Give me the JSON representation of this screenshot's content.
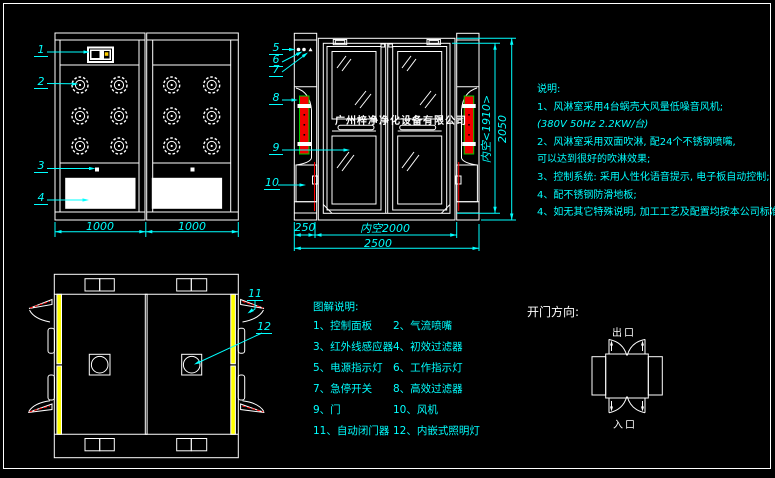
{
  "watermark": "广州梓净净化设备有限公司",
  "callouts": {
    "c1": "1",
    "c2": "2",
    "c3": "3",
    "c4": "4",
    "c5": "5",
    "c6": "6",
    "c7": "7",
    "c8": "8",
    "c9": "9",
    "c10": "10",
    "c11": "11",
    "c12": "12"
  },
  "dimensions": {
    "side_bay_left": "1000",
    "side_bay_right": "1000",
    "front_side_box": "250",
    "front_inner_width": "内空2000",
    "front_total_width": "2500",
    "front_inner_height": "内空<1910>",
    "front_total_height": "2050"
  },
  "legend": {
    "title": "图解说明:",
    "rows": [
      {
        "left": "1、控制面板",
        "right": "2、气流喷嘴"
      },
      {
        "left": "3、红外线感应器",
        "right": "4、初效过滤器"
      },
      {
        "left": "5、电源指示灯",
        "right": "6、工作指示灯"
      },
      {
        "left": "7、急停开关",
        "right": "8、高效过滤器"
      },
      {
        "left": "9、门",
        "right": "10、风机"
      },
      {
        "left": "11、自动闭门器",
        "right": "12、内嵌式照明灯"
      }
    ]
  },
  "notes": {
    "title": "说明:",
    "lines": [
      "1、风淋室采用4台蜗壳大风量低噪音风机;",
      "(380V  50Hz  2.2KW/台)",
      "2、风淋室采用双面吹淋, 配24个不锈钢喷嘴,",
      "可以达到很好的吹淋效果;",
      "3、控制系统: 采用人性化语音提示, 电子板自动控制;",
      "4、配不锈钢防滑地板;",
      "4、如无其它特殊说明, 加工工艺及配置均按本公司标准制作."
    ]
  },
  "door_direction": {
    "title": "开门方向:",
    "exit": "出口",
    "entrance": "入口"
  },
  "colors": {
    "annotation": "#00ffff",
    "linework": "#ffffff",
    "hepa_strip_fill": "#f20000",
    "hepa_strip_outline": "#00cc00",
    "lamp_strip": "#ffff00",
    "panel_highlight": "#ffcc00"
  }
}
